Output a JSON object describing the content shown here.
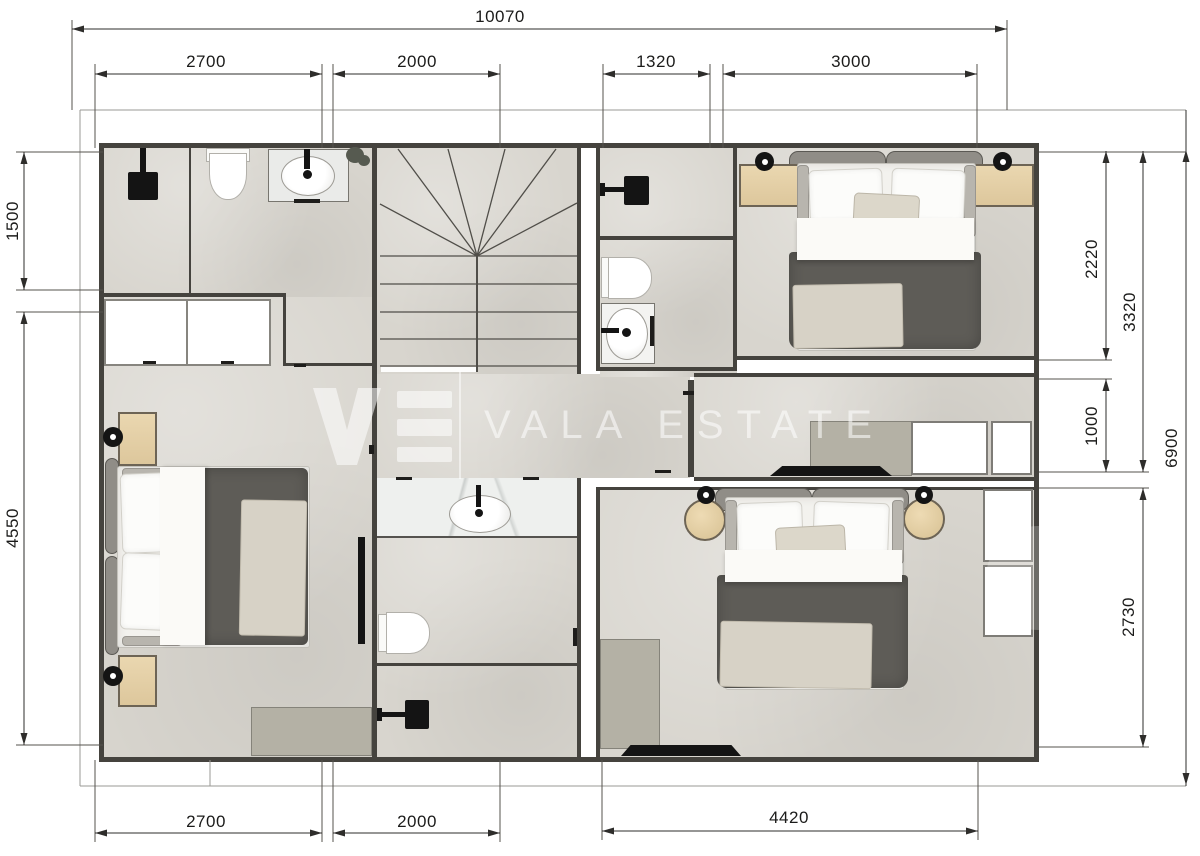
{
  "watermark": {
    "brand_text": "VALA ESTATE",
    "logo_letters": "VE"
  },
  "dimensions_mm": {
    "top_total": "10070",
    "top_segments": [
      "2700",
      "2000",
      "1320",
      "3000"
    ],
    "left_segments": [
      "1500",
      "4550"
    ],
    "right_segments": [
      "2220",
      "3320",
      "1000",
      "6900",
      "2730"
    ],
    "bottom_segments": [
      "2700",
      "2000",
      "4420"
    ]
  },
  "colors": {
    "background": "#ffffff",
    "floor": "#d8d5ce",
    "wall": "#45433e",
    "dimension_line": "#2e2d2b",
    "wood_furniture": "#e4cfa6",
    "duvet": "#5e5c57",
    "throw_blanket": "#d7d2c6",
    "marble_counter": "#eef0ee",
    "desk": "#b4b1a5",
    "watermark": "rgba(255,255,255,0.55)"
  },
  "icons": {
    "fixtures": [
      "shower-icon",
      "toilet-icon",
      "sink-icon",
      "lamp-icon",
      "tv-icon",
      "plant-icon"
    ]
  }
}
